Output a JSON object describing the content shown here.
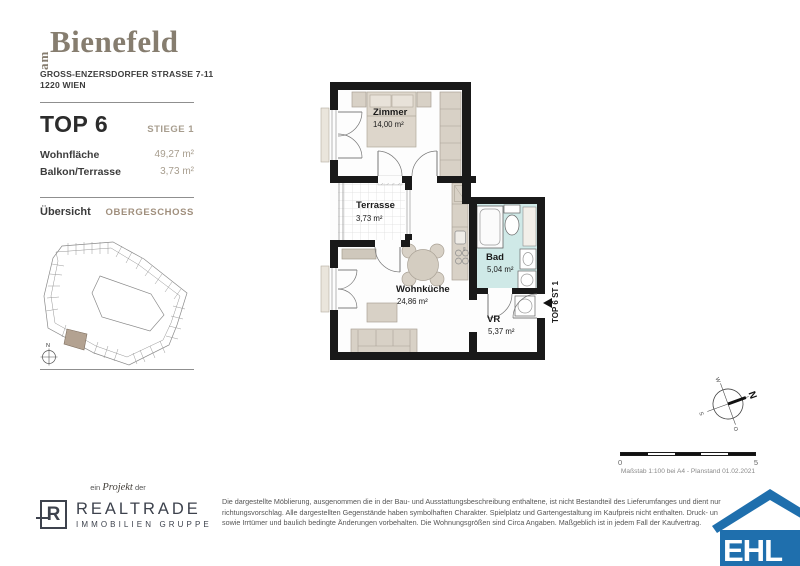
{
  "brand": {
    "prefix": "am",
    "name": "Bienefeld"
  },
  "address": {
    "line1": "GROSS-ENZERSDORFER STRASSE 7-11",
    "line2": "1220 WIEN"
  },
  "unit": {
    "title": "TOP 6",
    "stiege": "STIEGE 1",
    "rows": [
      {
        "label": "Wohnfläche",
        "value": "49,27 m²"
      },
      {
        "label": "Balkon/Terrasse",
        "value": "3,73 m²"
      }
    ]
  },
  "overview": {
    "title": "Übersicht",
    "level": "OBERGESCHOSS",
    "compass_n": "N"
  },
  "floorplan": {
    "rooms": [
      {
        "name": "Zimmer",
        "area": "14,00 m²"
      },
      {
        "name": "Terrasse",
        "area": "3,73 m²"
      },
      {
        "name": "Wohnküche",
        "area": "24,86 m²"
      },
      {
        "name": "Bad",
        "area": "5,04 m²"
      },
      {
        "name": "VR",
        "area": "5,37 m²"
      }
    ],
    "unit_marker": "TOP 6 ST 1",
    "kitchen_dim": "60"
  },
  "compass": {
    "n": "N",
    "o": "O",
    "s": "S",
    "w": "W"
  },
  "scalebar": {
    "start": "0",
    "end": "5",
    "caption": "Maßstab 1:100 bei A4 - Planstand 01.02.2021"
  },
  "footer": {
    "project_line": {
      "pre": "ein",
      "word": "Projekt",
      "post": "der"
    },
    "realtrade": {
      "monogram": "R",
      "name": "REALTRADE",
      "subtitle": "IMMOBILIEN GRUPPE"
    },
    "disclaimer": [
      "Die dargestellte Möblierung, ausgenommen die in der Bau- und Ausstattungsbeschreibung enthaltene, ist nicht Bestandteil des Lieferumfanges und dient nur",
      "richtungsvorschlag. Alle dargestellten Gegenstände haben symbolhaften Charakter. Spielplatz und Gartengestaltung im Kaufpreis nicht enthalten. Druck- un",
      "sowie Irrtümer und baulich bedingte Änderungen vorbehalten. Die Wohnungsgrößen sind Circa Angaben. Maßgeblich ist in jedem Fall der Kaufvertrag."
    ],
    "ehl": "EHL"
  },
  "colors": {
    "wall": "#191919",
    "furniture_beige": "#d8d1c6",
    "bad_floor": "#cfe9e7",
    "accent_taupe": "#a79d8e",
    "highlight_unit": "#b3a291",
    "ehl_blue": "#1f6fad"
  }
}
